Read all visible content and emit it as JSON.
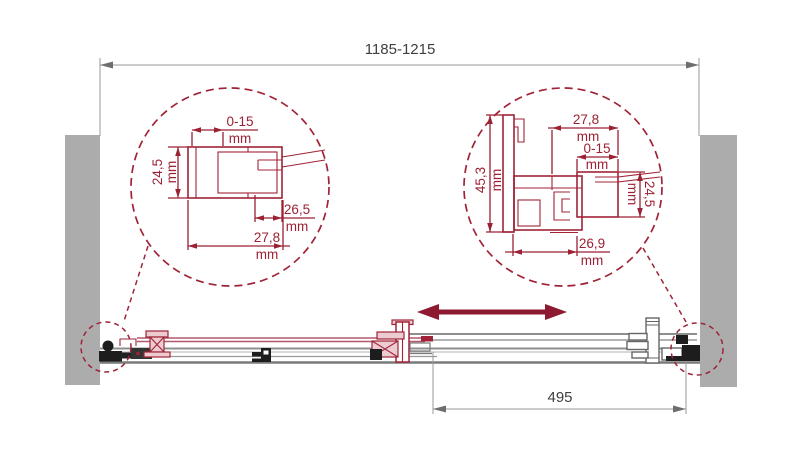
{
  "drawing": {
    "overall_width": "1185-1215",
    "slide_width": "495",
    "unit": "mm",
    "left_detail": {
      "adjust_range": "0-15",
      "profile_height": "24,5",
      "inner_depth": "26,5",
      "profile_width": "27,8"
    },
    "right_detail": {
      "profile_width": "27,8",
      "adjust_range": "0-15",
      "frame_height": "45,3",
      "profile_height": "24,5",
      "inner_depth": "26,9"
    },
    "colors": {
      "accent": "#9c2133",
      "arrow": "#8d1a30",
      "wall": "#acacac",
      "line_gray": "#9a9a9a",
      "component_black": "#1d1d1d",
      "text_dark": "#3f3f3f"
    }
  }
}
